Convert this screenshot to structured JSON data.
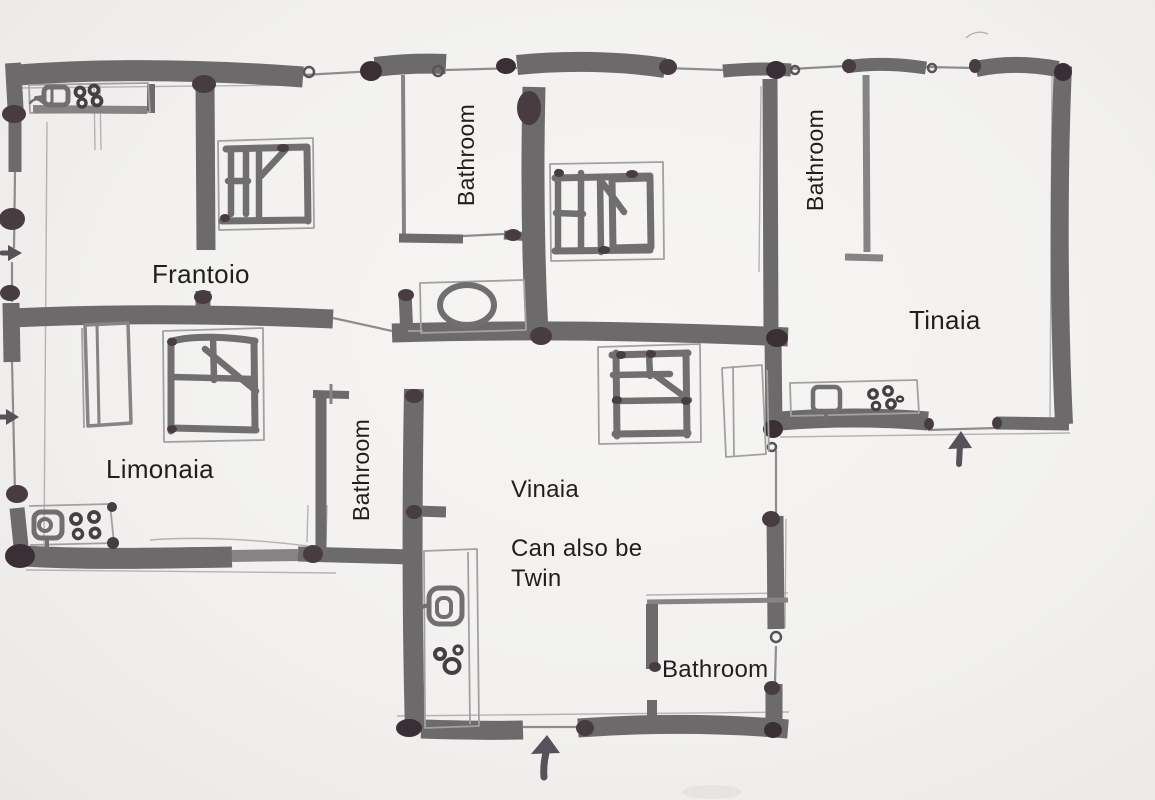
{
  "drawing": {
    "type": "hand-drawn floor plan sketch",
    "colors": {
      "paper": "#f2f1ef",
      "ink": "#6d6a6c",
      "ink_dark": "#463c41",
      "pencil": "#b5b2b4",
      "text": "#211f1d"
    }
  },
  "labels": {
    "frantoio": "Frantoio",
    "limonaia": "Limonaia",
    "vinaia": "Vinaia",
    "vinaia_note_line1": "Can also be",
    "vinaia_note_line2": "Twin",
    "tinaia": "Tinaia",
    "bathroom_top_middle": "Bathroom",
    "bathroom_top_right": "Bathroom",
    "bathroom_middle": "Bathroom",
    "bathroom_bottom": "Bathroom"
  }
}
